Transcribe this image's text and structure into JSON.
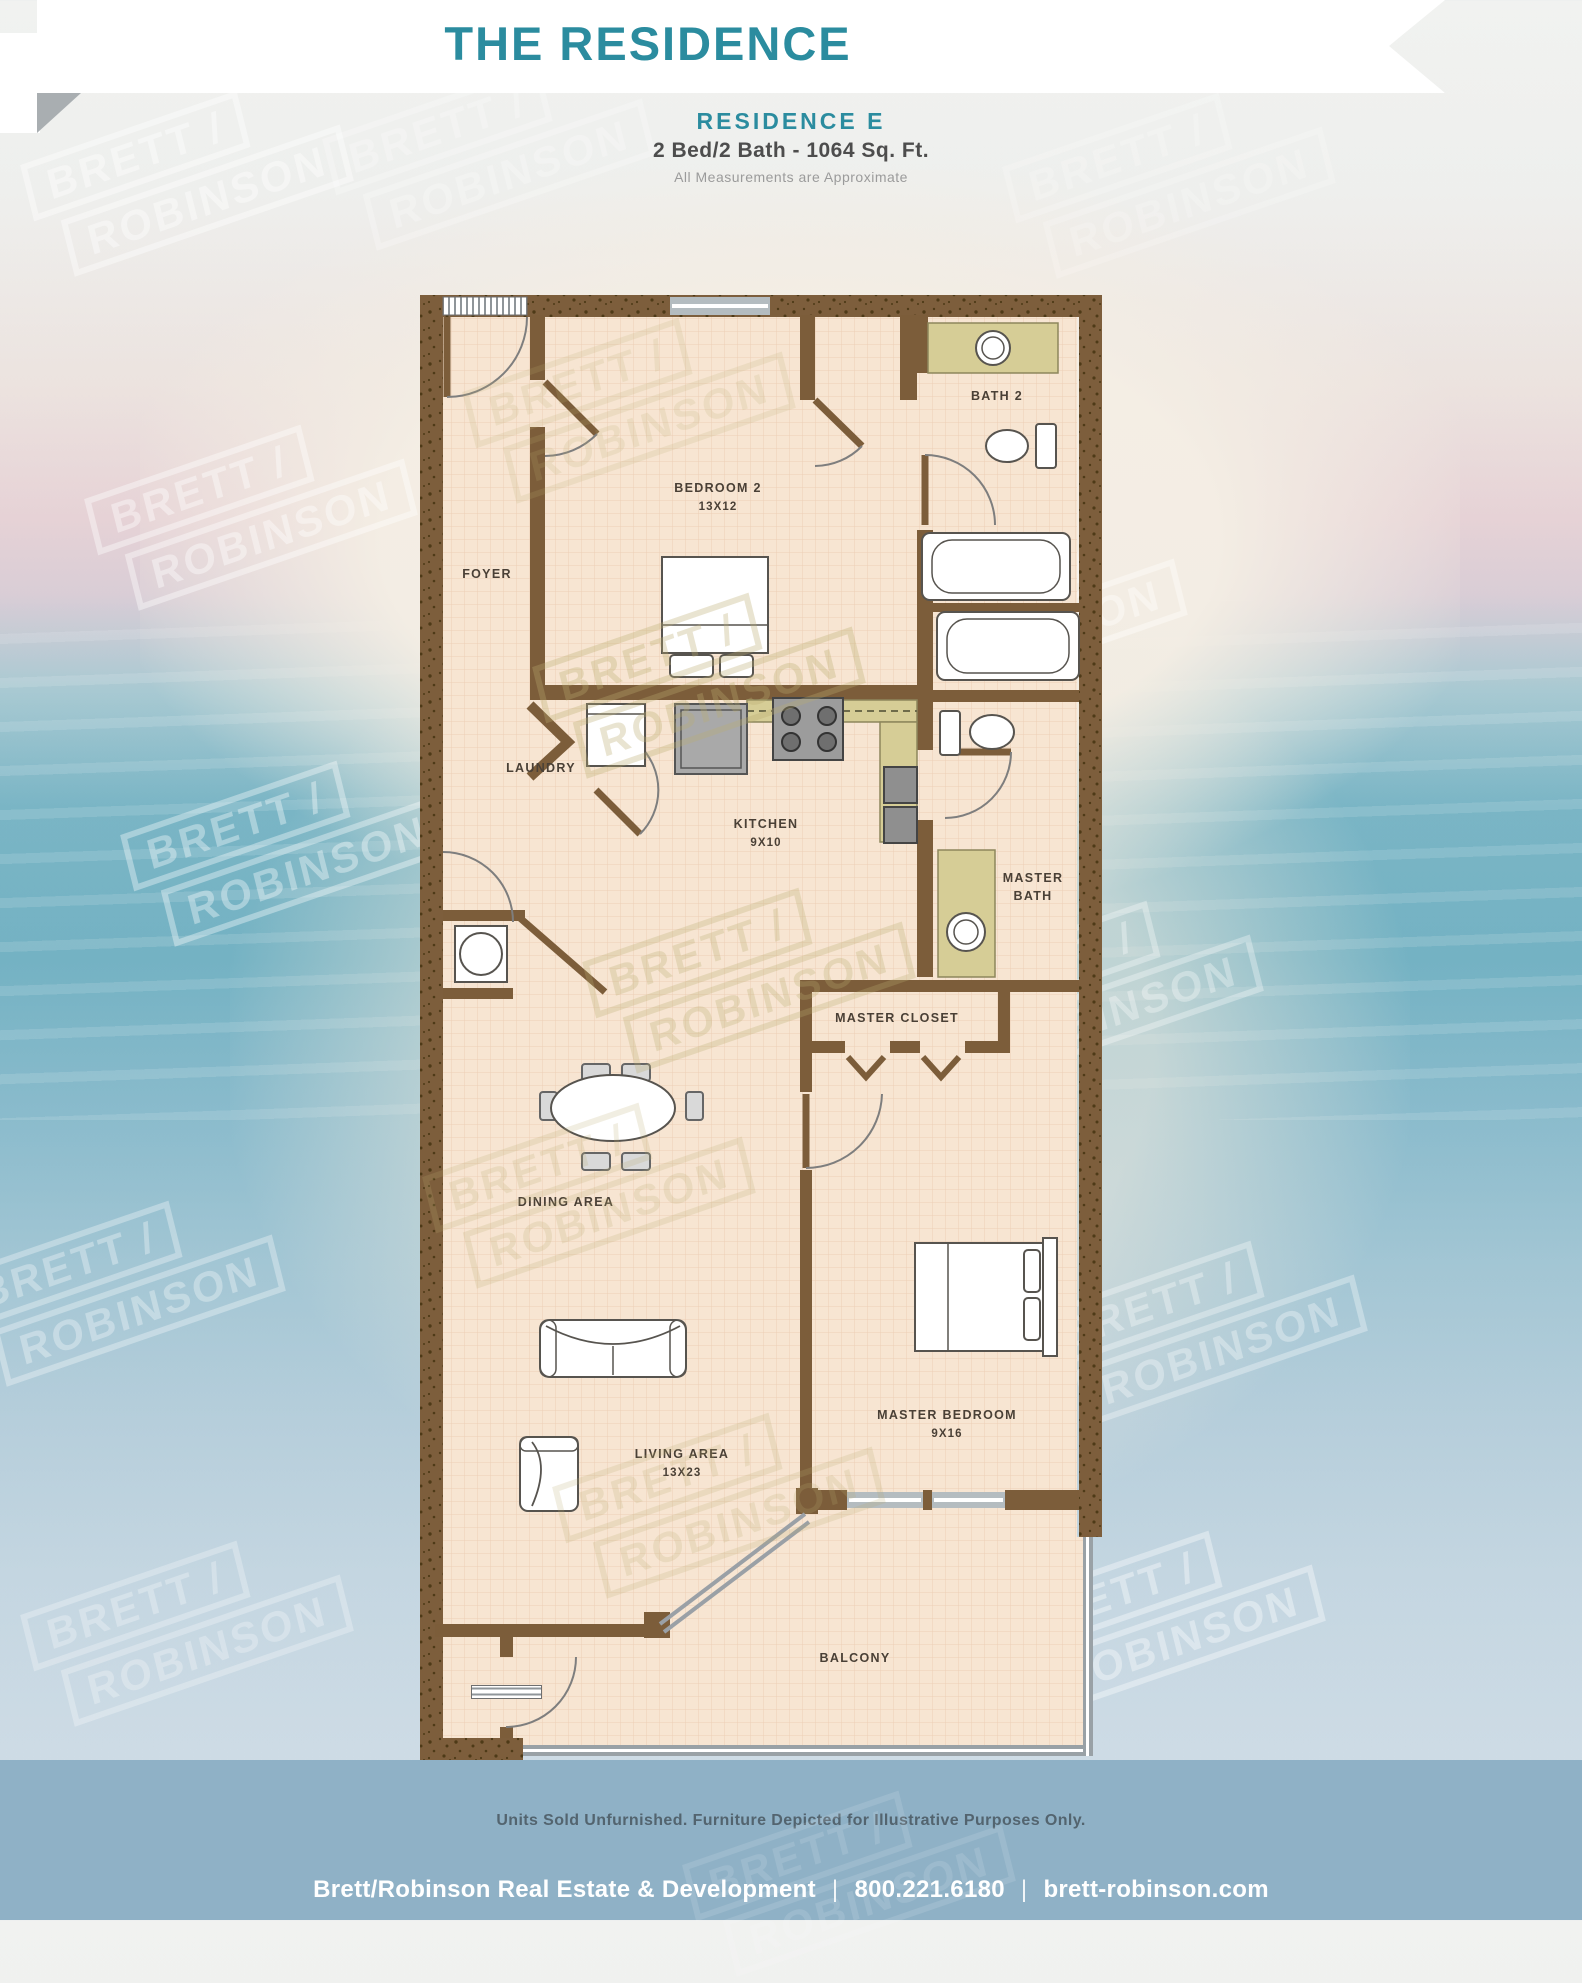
{
  "header": {
    "title": "THE RESIDENCE"
  },
  "subheader": {
    "residence": "RESIDENCE  E",
    "specs": "2 Bed/2 Bath - 1064 Sq. Ft.",
    "note": "All Measurements are Approximate"
  },
  "watermark": {
    "line1": "BRETT /",
    "line2": "ROBINSON"
  },
  "plan": {
    "rooms": {
      "foyer": {
        "label": "FOYER"
      },
      "bedroom2": {
        "label": "BEDROOM 2",
        "dims": "13X12"
      },
      "bath2": {
        "label": "BATH 2"
      },
      "laundry": {
        "label": "LAUNDRY"
      },
      "kitchen": {
        "label": "KITCHEN",
        "dims": "9X10"
      },
      "master_bath": {
        "label1": "MASTER",
        "label2": "BATH"
      },
      "master_closet": {
        "label": "MASTER CLOSET"
      },
      "dining": {
        "label": "DINING AREA"
      },
      "living": {
        "label": "LIVING AREA",
        "dims": "13X23"
      },
      "master_bedroom": {
        "label": "MASTER BEDROOM",
        "dims": "9X16"
      },
      "balcony": {
        "label": "BALCONY"
      }
    }
  },
  "footer": {
    "disclaimer": "Units Sold Unfurnished. Furniture Depicted for Illustrative Purposes Only.",
    "company": "Brett/Robinson Real Estate & Development",
    "phone": "800.221.6180",
    "website": "brett-robinson.com",
    "separator": "|"
  },
  "colors": {
    "accent_teal": "#2b8c9f",
    "wall_brown": "#7c5d3a",
    "floor_peach": "#f7e5d2",
    "counter_khaki": "#d6cd96",
    "footer_band_blue": "#8fb1c6"
  }
}
